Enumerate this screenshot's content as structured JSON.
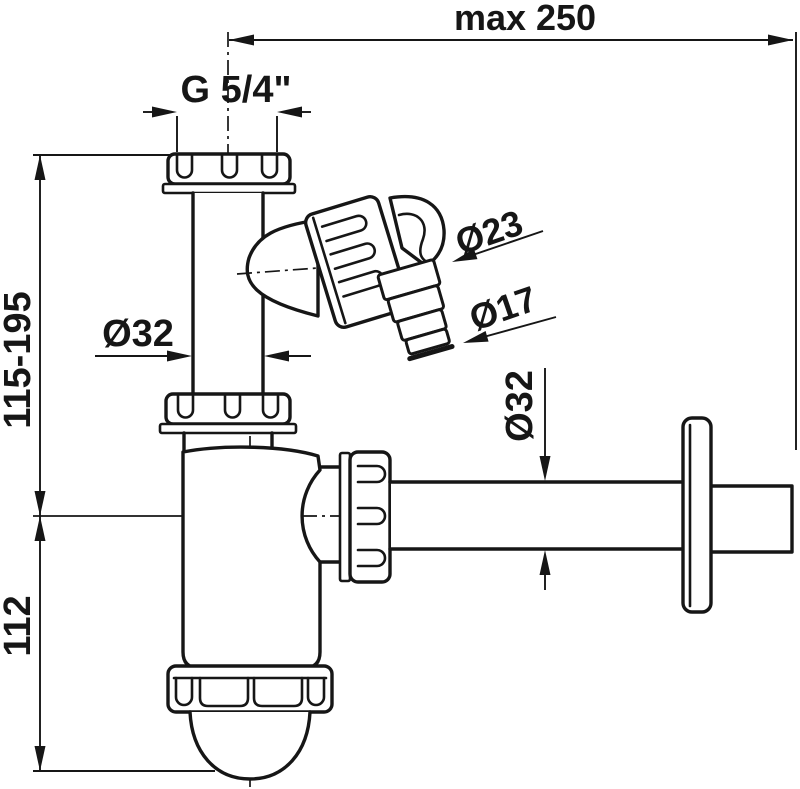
{
  "labels": {
    "max_width": "max 250",
    "thread_size": "G 5/4\"",
    "trap_height_range": "115-195",
    "body_height": "112",
    "inlet_pipe_diameter": "Ø32",
    "nozzle_outer_diameter": "Ø23",
    "nozzle_tip_diameter": "Ø17",
    "outlet_pipe_diameter": "Ø32"
  },
  "colors": {
    "line": "#161616",
    "background": "#ffffff"
  }
}
